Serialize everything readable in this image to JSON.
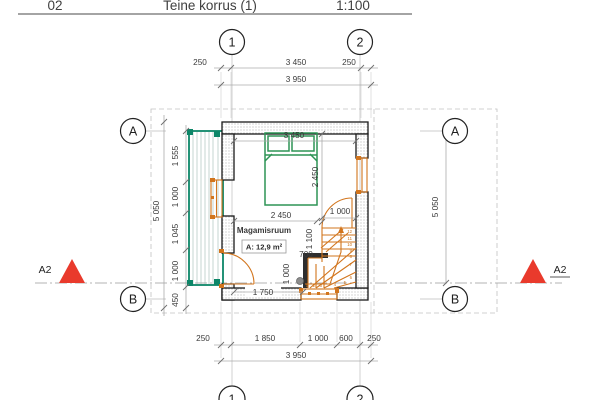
{
  "header": {
    "number": "02",
    "title": "Teine korrus (1)",
    "scale": "1:100"
  },
  "grid": {
    "col1": "1",
    "col2": "2",
    "rowA": "A",
    "rowB": "B"
  },
  "marker": {
    "label": "A2"
  },
  "room": {
    "name": "Magamisruum",
    "area": "A: 12,9 m²"
  },
  "dims": {
    "top_left": "250",
    "top_mid": "3 450",
    "top_right": "250",
    "top_total": "3 950",
    "left_1": "1 555",
    "left_2": "1 000",
    "left_3": "1 045",
    "left_4": "1 000",
    "left_5": "450",
    "left_total": "5 050",
    "right_total": "5 050",
    "bottom_1": "250",
    "bottom_2": "1 850",
    "bottom_3": "1 000",
    "bottom_4": "600",
    "bottom_5": "250",
    "bottom_total": "3 950",
    "room_width": "3 450",
    "bed_length": "2 450",
    "bed_width": "2 450",
    "door_width": "1 000",
    "stair_upper": "1 100",
    "landing": "700",
    "stair_lower": "1 000",
    "wall_inner": "1 750"
  },
  "stairs": {
    "n1": "1",
    "n2": "2",
    "n3": "3",
    "n4": "4",
    "n5": "5",
    "n6": "6",
    "n7": "7",
    "n8": "8",
    "n9": "9",
    "n10": "10",
    "n11": "11",
    "n12": "12"
  },
  "colors": {
    "stair_orange": "#d2751d",
    "bed_green": "#2d9455",
    "balcony_teal": "#0c8668",
    "room_label_red": "#b2544c",
    "marker_red": "#e93a2c"
  }
}
